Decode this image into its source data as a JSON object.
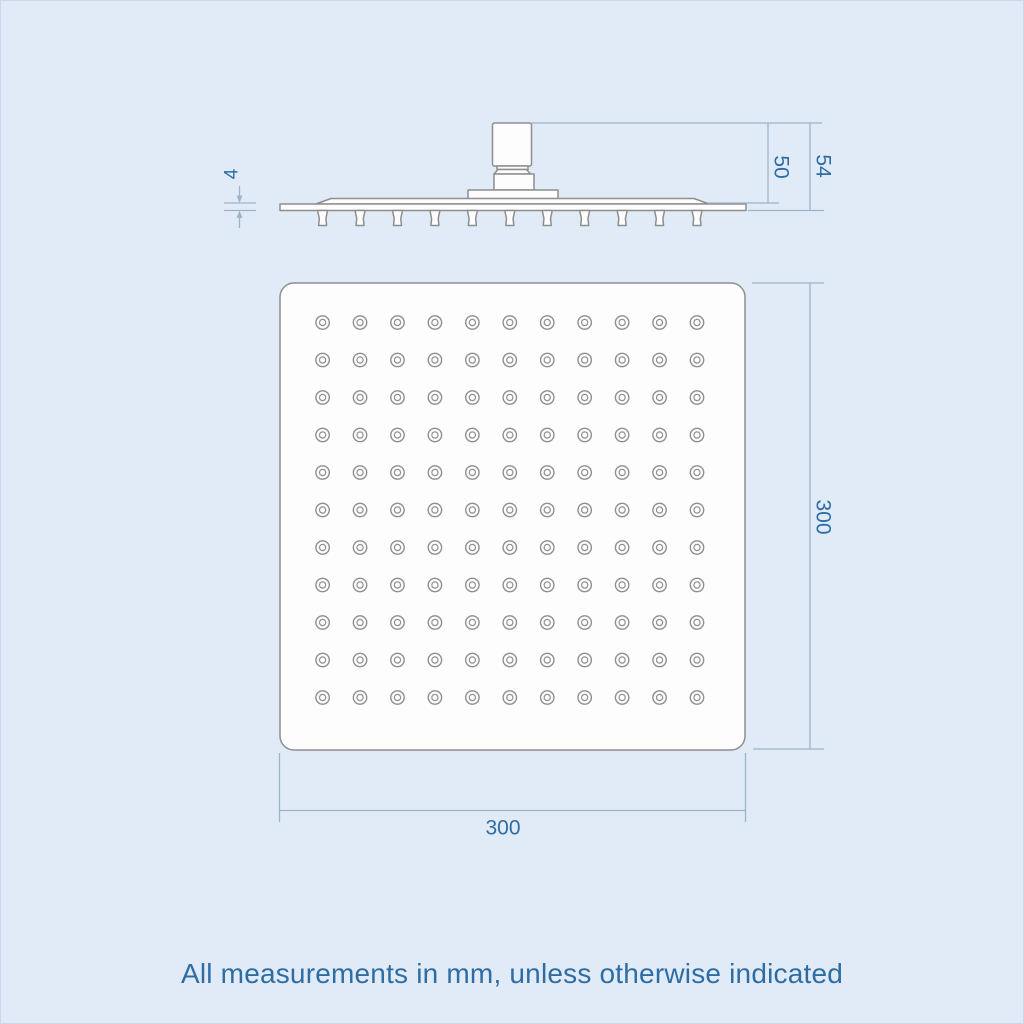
{
  "page": {
    "background_color": "#e0ebf7",
    "caption": "All measurements in mm, unless otherwise indicated"
  },
  "colors": {
    "dimension_text": "#2e6da4",
    "dimension_line": "#9cb4c8",
    "drawing_line": "#8e8e8e",
    "shape_fill": "#fdfdfe"
  },
  "dimensions": {
    "side_view": {
      "plate_thickness": "4",
      "connector_height": "50",
      "total_height": "54"
    },
    "front_view": {
      "height": "300",
      "width": "300"
    }
  },
  "front_view": {
    "nozzle_grid": {
      "rows": 11,
      "columns": 11
    }
  },
  "units_note": "mm"
}
